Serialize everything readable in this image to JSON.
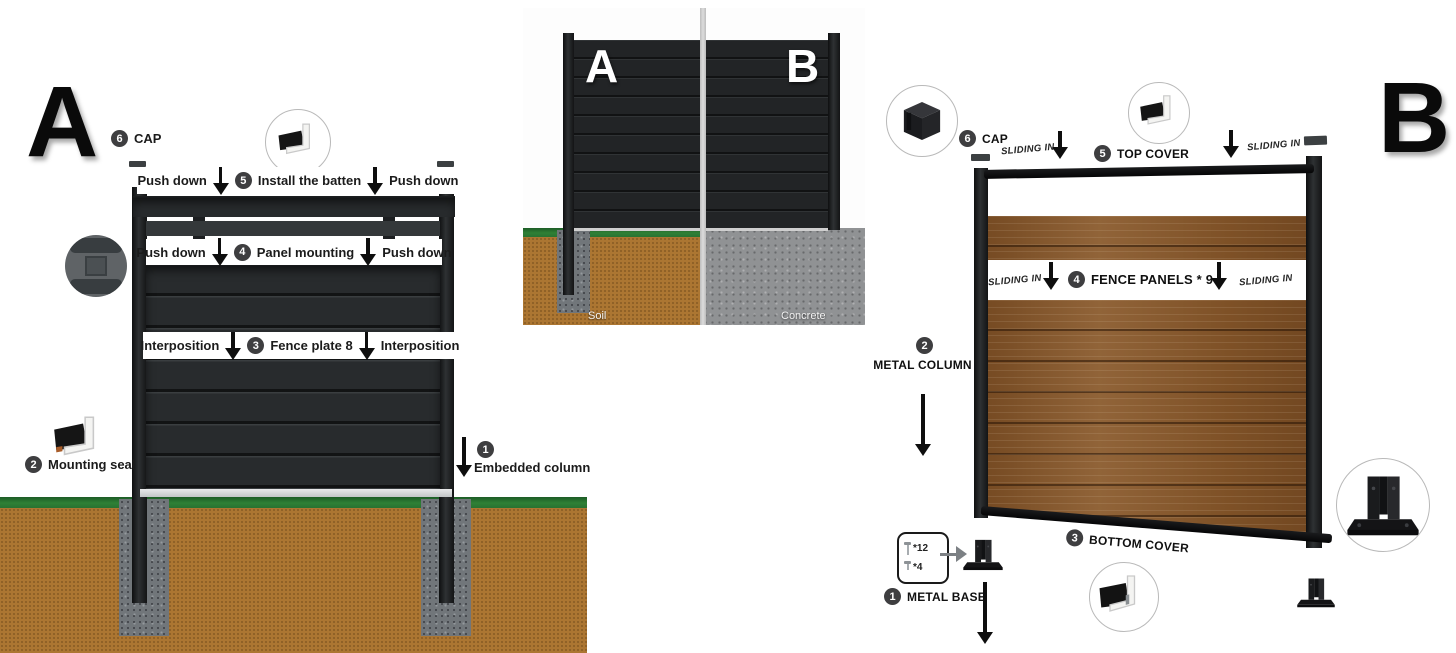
{
  "a": {
    "letter": "A",
    "cap_num": "6",
    "cap_label": "CAP",
    "batten_num": "5",
    "batten_label": "Install the batten",
    "push_down": "Push down",
    "panel_num": "4",
    "panel_label": "Panel mounting",
    "interposition": "Interposition",
    "plate_num": "3",
    "plate_label": "Fence plate 8",
    "seal_num": "2",
    "seal_label": "Mounting seal",
    "embed_num": "1",
    "embed_label": "Embedded column"
  },
  "compare": {
    "letter_a": "A",
    "letter_b": "B",
    "ground_a": "Soil",
    "ground_b": "Concrete"
  },
  "b": {
    "letter": "B",
    "sliding_in": "SLIDING IN",
    "cap_num": "6",
    "cap_label": "CAP",
    "top_cover_num": "5",
    "top_cover_label": "TOP COVER",
    "panels_num": "4",
    "panels_label": "FENCE PANELS * 9",
    "column_num": "2",
    "column_label": "METAL COLUMN",
    "bottom_cover_num": "3",
    "bottom_cover_label": "BOTTOM COVER",
    "base_num": "1",
    "base_label": "METAL BASE",
    "screws_long": "*12",
    "screws_short": "*4"
  },
  "colors": {
    "wood": "#8a5a2c",
    "soil": "#ac7632",
    "grass": "#2f8036",
    "concrete": "#909294",
    "footing": "#71767a",
    "panel_dark": "#282b2d",
    "post_black": "#131415",
    "label_band": "#ffffff"
  }
}
